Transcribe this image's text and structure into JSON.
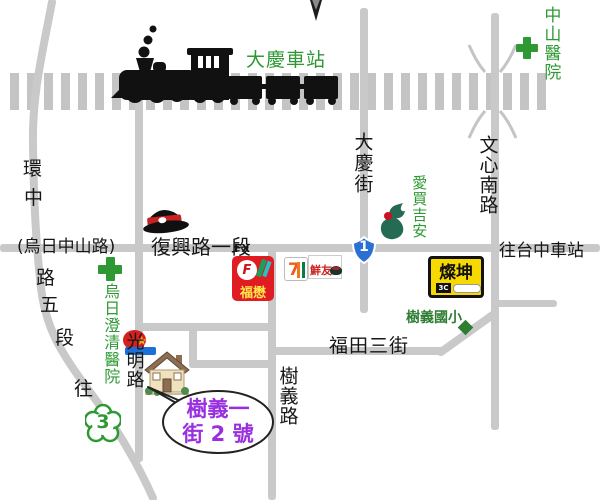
{
  "colors": {
    "road": "#c9c9c9",
    "railway": "#c4c4c4",
    "green_label": "#2e9933",
    "school_green": "#2e7d32",
    "callout_purple": "#9a2fe0",
    "route1_blue": "#2b6fd4",
    "tsannkuen_yellow": "#f7d900",
    "fumao_red": "#e11b22"
  },
  "station": {
    "label": "大慶車站"
  },
  "hospitals": {
    "zhongshan": {
      "label": "中山醫院"
    },
    "wuri": {
      "label": "烏日澄清醫院"
    }
  },
  "roads": {
    "huanzhong_chars": [
      "環",
      "中",
      "路",
      "五",
      "段",
      "往"
    ],
    "wuri_zhongshan": "(烏日中山路)",
    "fuxing": "復興路一段",
    "daqing_street": "大慶街",
    "wenxin_south": "文心南路",
    "guangming": "光明路",
    "shuyi_road": "樹義路",
    "futian_3rd": "福田三街",
    "to_taichung_station": "往台中車站"
  },
  "route_markers": {
    "provincial_1": "1",
    "provincial_3": "3"
  },
  "stores": {
    "fumao": {
      "fx": "FX",
      "name": "福懋"
    },
    "seven_eleven": {
      "seven": "7"
    },
    "xianyou": {
      "name": "鮮友"
    },
    "aimai": {
      "name": "愛買吉安"
    },
    "tsannkuen": {
      "name": "燦坤",
      "badge": "3C"
    }
  },
  "school": {
    "name": "樹義國小"
  },
  "callout": {
    "line1": "樹義一",
    "line2": "街 2 號"
  },
  "icons": {
    "steam-train": "black silhouette locomotive with three wagons",
    "compass-north": "four-point star partly off top edge",
    "station-master-cap": "black cap with red band",
    "green-cross": "hospital cross",
    "route1-shield": "blue provincial highway shield",
    "route3-flower": "green plum-blossom route marker",
    "school-pin": "dark green diamond",
    "destination-house": "cartoon house",
    "store-logo": "red circle with star and blue banner",
    "hotpot-pot": "dark hotpot bowl"
  }
}
